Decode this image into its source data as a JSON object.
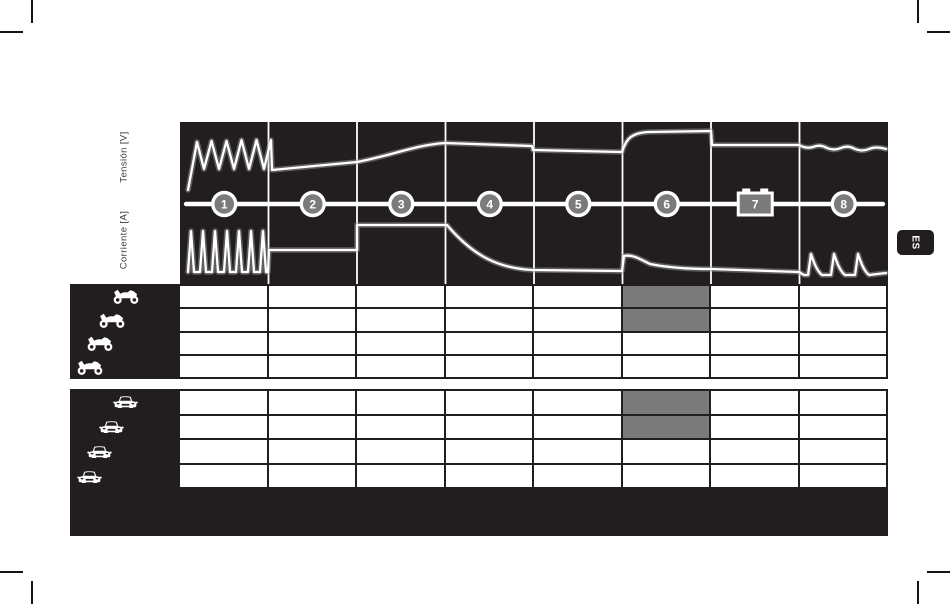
{
  "meta": {
    "language_tab": "ES"
  },
  "chart": {
    "axis_labels": {
      "voltage": "Tensión [V]",
      "current": "Corriente [A]"
    },
    "colors": {
      "background": "#221e1f",
      "curve": "#ffffff",
      "grid": "#ffffff",
      "marker_fill": "#7b7b7b",
      "highlight": "#7a7a7a"
    },
    "markers": [
      {
        "label": "1",
        "type": "circle"
      },
      {
        "label": "2",
        "type": "circle"
      },
      {
        "label": "3",
        "type": "circle"
      },
      {
        "label": "4",
        "type": "circle"
      },
      {
        "label": "5",
        "type": "circle"
      },
      {
        "label": "6",
        "type": "circle"
      },
      {
        "label": "7",
        "type": "battery"
      },
      {
        "label": "8",
        "type": "circle"
      }
    ]
  },
  "chart_data": {
    "type": "line",
    "x_unit": "charging step",
    "steps": [
      "1",
      "2",
      "3",
      "4",
      "5",
      "6",
      "7",
      "8"
    ],
    "canvas": {
      "w": 708,
      "h": 162
    },
    "axis_y": 82,
    "grid_x": [
      88.5,
      177,
      265.5,
      354,
      442.5,
      531,
      619.5
    ],
    "marker_centers": [
      44.25,
      132.75,
      221.25,
      309.75,
      398.25,
      486.75,
      575.25,
      663.75
    ],
    "series": [
      {
        "name": "Tensión [V]",
        "shape_by_step": [
          "pulse oscillation",
          "slow rise",
          "ramp up",
          "flat high",
          "slight drop flat",
          "boost rise high",
          "flat float",
          "small ripple"
        ],
        "path": "M8,68 L17,20 L24,47 L31.5,19 L39,47 L46.5,19 L54,47 L61.5,18 L69,47 L76.5,18 L84,47 L91,18 L92,48 L177,40 C210,34 235,23 265,21 L352,24 L353,28 L442,30 C446,17 451,11 468,10 L531,9 L532,23 L619,23 Q626,27 633,25 Q640,22 647,26 Q654,29 661,26 Q668,23 675,27 Q682,30 689,27 Q696,24 706,27"
      },
      {
        "name": "Corriente [A]",
        "shape_by_step": [
          "pulse train",
          "constant medium",
          "constant high",
          "exponential decay",
          "constant low",
          "small bump decay",
          "constant low decline",
          "maintenance pulses"
        ],
        "path": "M8,150 L11,109 L14,150 L20,150 L23,109 L26,150 L32,150 L35,109 L38,150 L44,150 L47,109 L50,150 L56,150 L59,109 L62,150 L68,150 L71,109 L74,150 L80,150 L83,109 L86,150 L88,150 L89,128 L177,128 L177,103 L267,103 C295,136 320,146 352,148 L442,149 L444,134 C452,132 460,137 470,142 C490,146 510,147 531,147 L619,150 L624,153 L628,153 L631,132 C634,141 637,149 642,153 L651,153 L654,132 C657,141 660,149 665,153 L675,153 L678,132 C681,141 684,149 689,153 L706,151"
      }
    ],
    "legend_position": "left-rotated",
    "grid": "vertical step dividers only"
  },
  "tables": [
    {
      "dom_id": "tbl-moto",
      "vehicle": "motorcycle",
      "icon_name": "motorcycle-icon",
      "symbol": "sym-moto",
      "rows": 4,
      "cols": 8,
      "row_h": 23.75,
      "icon_w": 28,
      "icon_h": 18,
      "icon_offsets_x": [
        42,
        28,
        16,
        6
      ],
      "highlighted": [
        [
          0,
          5
        ],
        [
          1,
          5
        ]
      ]
    },
    {
      "dom_id": "tbl-car",
      "vehicle": "car",
      "icon_name": "car-icon",
      "symbol": "sym-car",
      "rows": 4,
      "cols": 8,
      "row_h": 25,
      "icon_w": 27,
      "icon_h": 16,
      "icon_offsets_x": [
        42,
        28,
        16,
        6
      ],
      "highlighted": [
        [
          0,
          5
        ],
        [
          1,
          5
        ]
      ]
    }
  ]
}
